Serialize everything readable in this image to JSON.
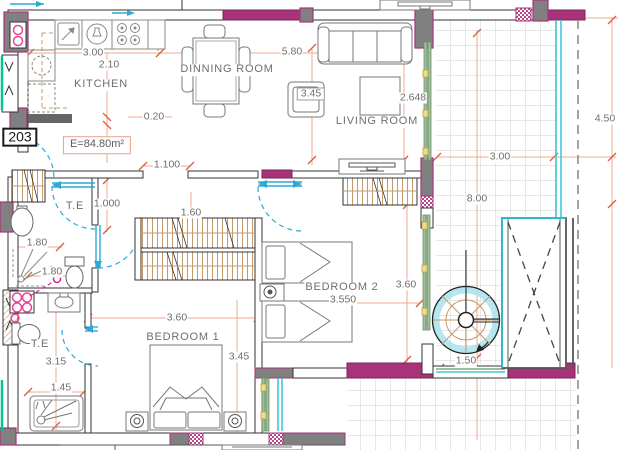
{
  "unit": {
    "number": "203",
    "area_label": "E=84.80m²"
  },
  "rooms": {
    "kitchen": "KITCHEN",
    "dining": "DINNING ROOM",
    "living": "LIVING ROOM",
    "bedroom1": "BEDROOM 1",
    "bedroom2": "BEDROOM 2",
    "toilet_upper": "T.E",
    "toilet_lower": "T.E"
  },
  "dimensions": {
    "kitchen_width": "3.00",
    "kitchen_counter": "2.10",
    "wall_offset": "0.20",
    "dining_width": "5.80",
    "armchair_box": "3.45",
    "living_depth": "2.648",
    "hall_opening": "1.100",
    "hall_width": "1.000",
    "wardrobe_len": "1.60",
    "bath1_width": "1.80",
    "bath1_width2": "1.80",
    "bedroom1_width": "3.60",
    "bedroom1_depth": "3.45",
    "bedroom2_width": "3.550",
    "bedroom2_depth": "3.60",
    "balcony_width": "3.00",
    "balcony_length": "8.00",
    "balcony_side": "4.50",
    "bath2_depth": "3.15",
    "bath2_width": "1.45",
    "stair_opening": "1.50"
  },
  "colors": {
    "wall_accent_magenta": "#A8337B",
    "wall_fill_gray": "#808080",
    "dimension_line": "#F2A98C",
    "dimension_tick": "#D96040",
    "text_gray": "#6E6E6E",
    "door_arc_cyan": "#2FA8D5",
    "window_cyan": "#45C6D8",
    "glass_teal": "#00C693",
    "sliding_door_green": "#9FBF9C",
    "handle_yellow": "#EFDC8F",
    "wood_hatch_tan": "#C4996B",
    "fixture_pink": "#E8459A",
    "tile_line": "#CFCFCF"
  }
}
